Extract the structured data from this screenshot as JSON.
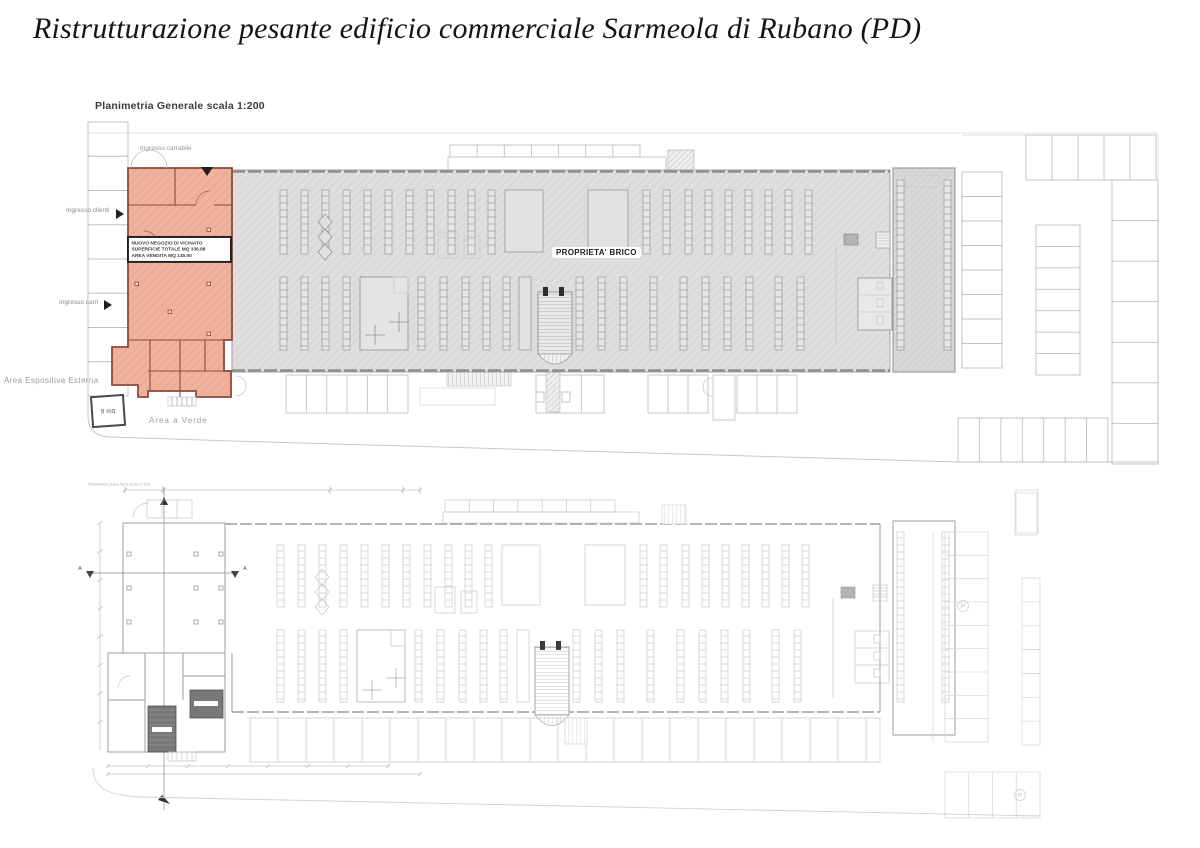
{
  "title": "Ristrutturazione pesante edificio commerciale Sarmeola di Rubano (PD)",
  "top_plan": {
    "title": "Planimetria Generale scala 1:200",
    "scale": "1:200",
    "labels": {
      "ingresso_top": "Ingresso carrabile",
      "ingresso_clienti": "Ingresso clienti",
      "ingresso_carri": "Ingresso carri",
      "proprieta": "PROPRIETA' BRICO",
      "area_espositiva": "Area Espositiva Esterna",
      "area_verde": "Area a Verde",
      "mq_box": "9 mq"
    },
    "info_box": {
      "line1": "NUOVO NEGOZIO DI VICINATO",
      "line2": "SUPERFICIE TOTALE MQ 336.88",
      "line3": "AREA VENDITA MQ 145.00"
    }
  },
  "bottom_plan": {
    "title": "Planimetria piano terra scala 1:100",
    "section_marker": "A",
    "parking_symbol": "P"
  },
  "colors": {
    "highlight_fill": "#F0B19D",
    "highlight_wall": "#8C4A38",
    "building_fill": "#DEDEDE",
    "line_gray": "#9A9A9A"
  }
}
